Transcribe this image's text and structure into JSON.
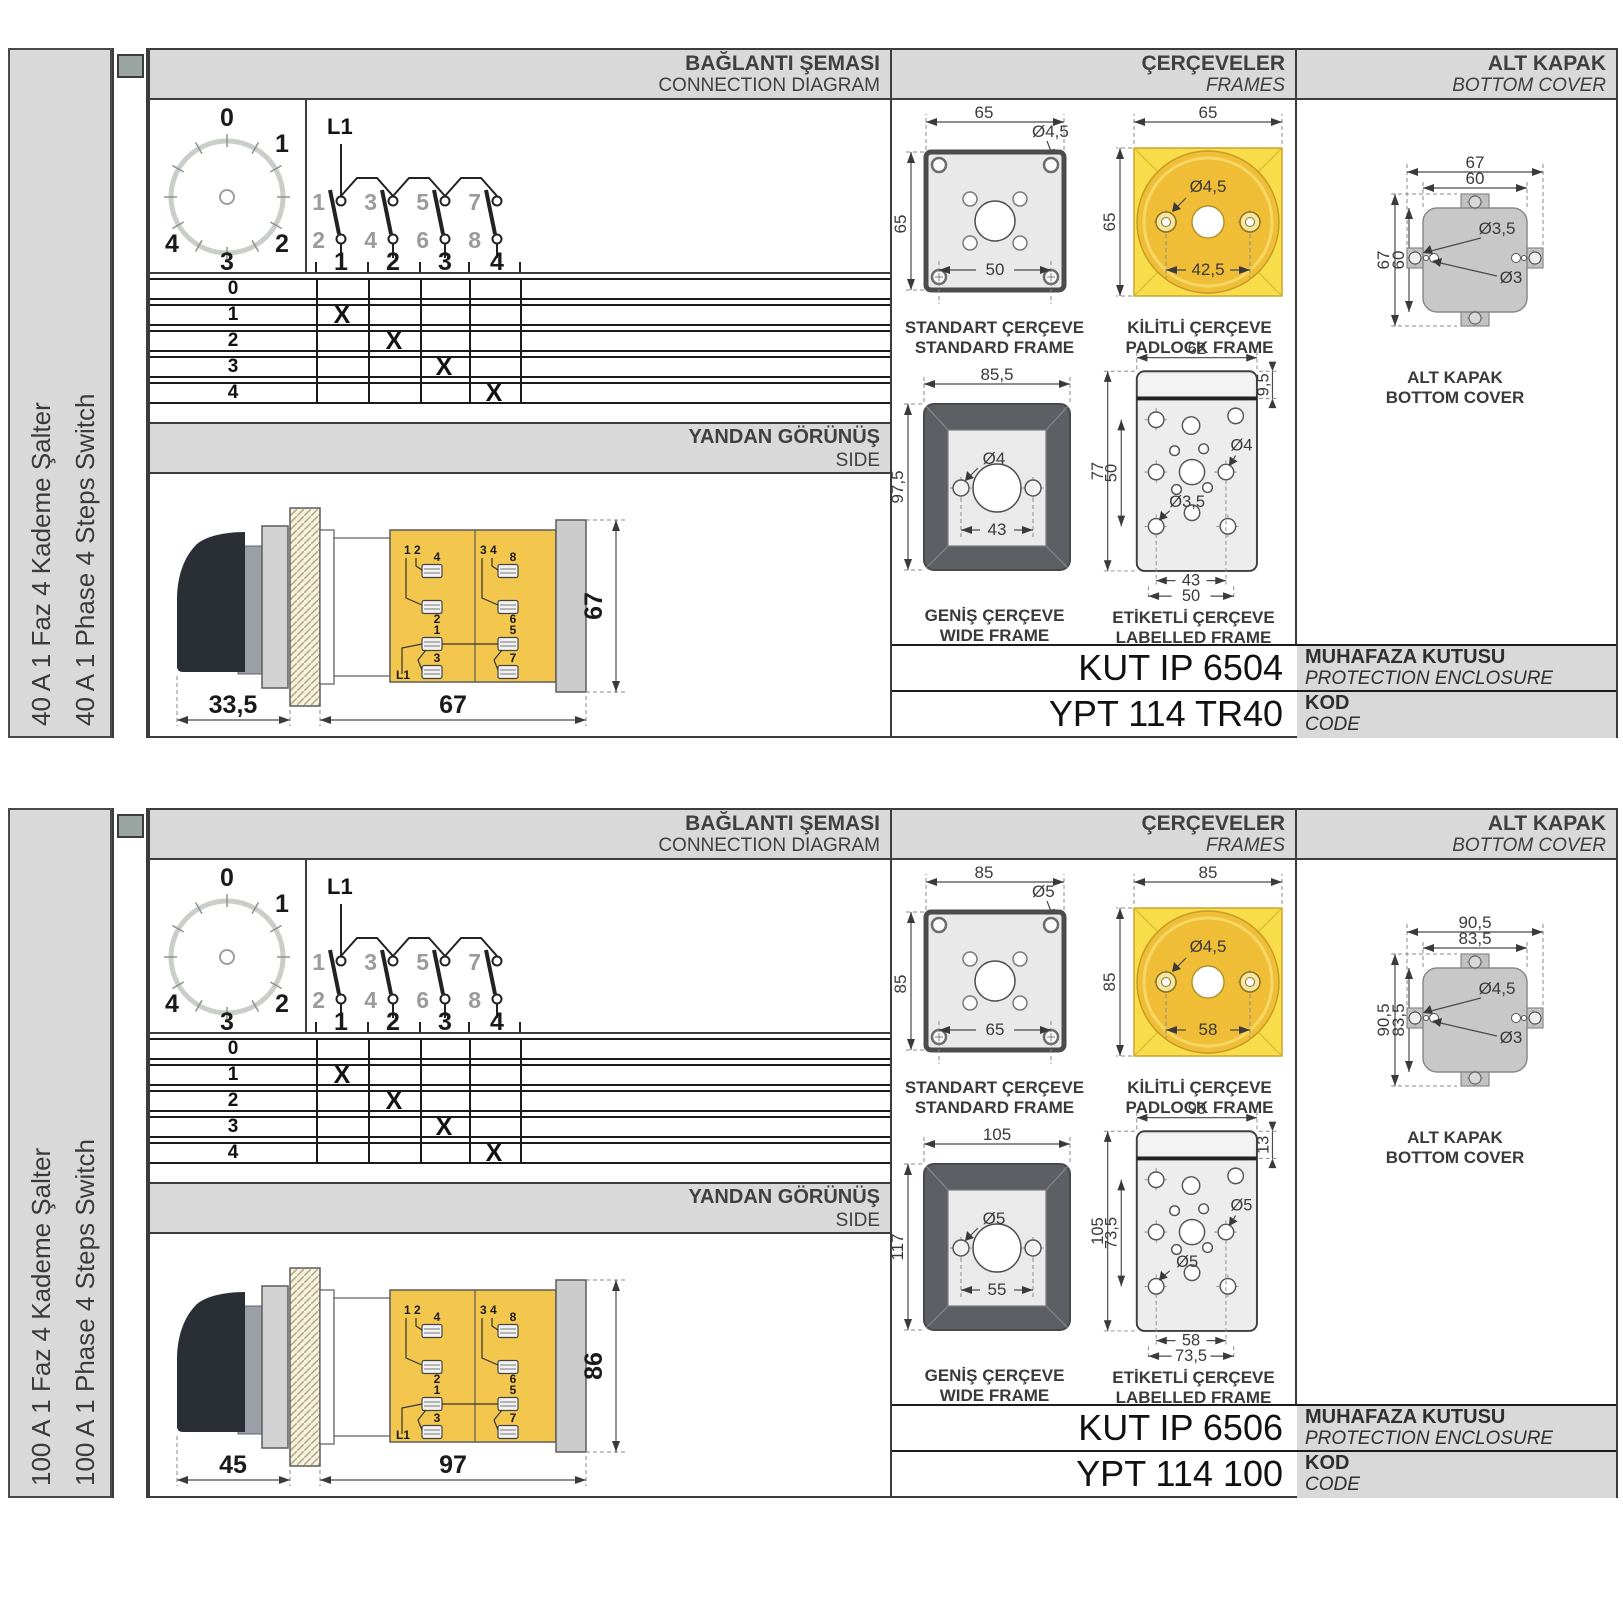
{
  "colors": {
    "panel_gray": "#d9d9d9",
    "border_dark": "#3c3c3c",
    "line_black": "#1a1a1a",
    "yellow_frame": "#f9dc49",
    "yellow_circle": "#f0bd37",
    "body_yellow": "#f3c74d",
    "frame_dark_gray": "#5c6065",
    "cover_gray": "#c8c8c8",
    "spine_square": "#9ba6a2",
    "text_dark": "#3a3a3a"
  },
  "sections": [
    {
      "side_label_tr": "40 A 1 Faz 4 Kademe Şalter",
      "side_label_en": "40 A 1 Phase 4 Steps Switch",
      "header": {
        "connection_tr": "BAĞLANTI ŞEMASI",
        "connection_en": "CONNECTION DIAGRAM",
        "frames_tr": "ÇERÇEVELER",
        "frames_en": "FRAMES",
        "cover_tr": "ALT KAPAK",
        "cover_en": "BOTTOM COVER"
      },
      "dial": {
        "labels": [
          "0",
          "1",
          "2",
          "3",
          "4"
        ]
      },
      "schematic": {
        "source": "L1",
        "top": [
          "1",
          "3",
          "5",
          "7"
        ],
        "bottom": [
          "2",
          "4",
          "6",
          "8"
        ],
        "out": [
          "1",
          "2",
          "3",
          "4"
        ]
      },
      "table": {
        "rows": [
          {
            "label": "0",
            "cells": [
              "",
              "",
              "",
              ""
            ]
          },
          {
            "label": "1",
            "cells": [
              "X",
              "",
              "",
              ""
            ]
          },
          {
            "label": "2",
            "cells": [
              "",
              "X",
              "",
              ""
            ]
          },
          {
            "label": "3",
            "cells": [
              "",
              "",
              "X",
              ""
            ]
          },
          {
            "label": "4",
            "cells": [
              "",
              "",
              "",
              "X"
            ]
          }
        ]
      },
      "side_view": {
        "title_tr": "YANDAN GÖRÜNÜŞ",
        "title_en": "SIDE",
        "dim_front": "33,5",
        "dim_body": "67",
        "dim_height": "67",
        "hdr_left": "1 2",
        "hdr_right": "3 4",
        "terminals": [
          "4",
          "2",
          "1",
          "3",
          "8",
          "6",
          "5",
          "7"
        ],
        "source": "L1"
      },
      "frames": {
        "standard": {
          "cap_tr": "STANDART ÇERÇEVE",
          "cap_en": "STANDARD FRAME",
          "dim_w": "65",
          "dim_h": "65",
          "hole": "Ø4,5",
          "dim_inner": "50"
        },
        "padlock": {
          "cap_tr": "KİLİTLİ ÇERÇEVE",
          "cap_en": "PADLOCK FRAME",
          "dim_w": "65",
          "dim_h": "65",
          "hole": "Ø4,5",
          "dim_inner": "42,5"
        },
        "wide": {
          "cap_tr": "GENİŞ ÇERÇEVE",
          "cap_en": "WIDE FRAME",
          "dim_w": "85,5",
          "dim_h": "97,5",
          "hole": "Ø4",
          "dim_inner": "43"
        },
        "labelled": {
          "cap_tr": "ETİKETLİ ÇERÇEVE",
          "cap_en": "LABELLED FRAME",
          "dim_w": "62",
          "dim_band": "9,5",
          "dim_h_outer": "77",
          "dim_h_inner": "50",
          "hole_right": "Ø4",
          "hole_left": "Ø3,5",
          "dim_inner": "43",
          "dim_outer": "50"
        }
      },
      "cover": {
        "cap_tr": "ALT KAPAK",
        "cap_en": "BOTTOM COVER",
        "dim_w_outer": "67",
        "dim_w_inner": "60",
        "dim_h_outer": "67",
        "dim_h_inner": "60",
        "hole_big": "Ø3,5",
        "hole_small": "Ø3"
      },
      "codes": {
        "enclosure_code": "KUT IP 6504",
        "enclosure_tr": "MUHAFAZA KUTUSU",
        "enclosure_en": "PROTECTION ENCLOSURE",
        "code": "YPT 114 TR40",
        "kod_tr": "KOD",
        "kod_en": "CODE"
      }
    },
    {
      "side_label_tr": "100 A 1 Faz 4 Kademe Şalter",
      "side_label_en": "100 A 1 Phase 4 Steps Switch",
      "header": {
        "connection_tr": "BAĞLANTI ŞEMASI",
        "connection_en": "CONNECTION DIAGRAM",
        "frames_tr": "ÇERÇEVELER",
        "frames_en": "FRAMES",
        "cover_tr": "ALT KAPAK",
        "cover_en": "BOTTOM COVER"
      },
      "dial": {
        "labels": [
          "0",
          "1",
          "2",
          "3",
          "4"
        ]
      },
      "schematic": {
        "source": "L1",
        "top": [
          "1",
          "3",
          "5",
          "7"
        ],
        "bottom": [
          "2",
          "4",
          "6",
          "8"
        ],
        "out": [
          "1",
          "2",
          "3",
          "4"
        ]
      },
      "table": {
        "rows": [
          {
            "label": "0",
            "cells": [
              "",
              "",
              "",
              ""
            ]
          },
          {
            "label": "1",
            "cells": [
              "X",
              "",
              "",
              ""
            ]
          },
          {
            "label": "2",
            "cells": [
              "",
              "X",
              "",
              ""
            ]
          },
          {
            "label": "3",
            "cells": [
              "",
              "",
              "X",
              ""
            ]
          },
          {
            "label": "4",
            "cells": [
              "",
              "",
              "",
              "X"
            ]
          }
        ]
      },
      "side_view": {
        "title_tr": "YANDAN GÖRÜNÜŞ",
        "title_en": "SIDE",
        "dim_front": "45",
        "dim_body": "97",
        "dim_height": "86",
        "hdr_left": "1 2",
        "hdr_right": "3 4",
        "terminals": [
          "4",
          "2",
          "1",
          "3",
          "8",
          "6",
          "5",
          "7"
        ],
        "source": "L1"
      },
      "frames": {
        "standard": {
          "cap_tr": "STANDART ÇERÇEVE",
          "cap_en": "STANDARD FRAME",
          "dim_w": "85",
          "dim_h": "85",
          "hole": "Ø5",
          "dim_inner": "65"
        },
        "padlock": {
          "cap_tr": "KİLİTLİ ÇERÇEVE",
          "cap_en": "PADLOCK FRAME",
          "dim_w": "85",
          "dim_h": "85",
          "hole": "Ø4,5",
          "dim_inner": "58"
        },
        "wide": {
          "cap_tr": "GENİŞ ÇERÇEVE",
          "cap_en": "WIDE FRAME",
          "dim_w": "105",
          "dim_h": "117",
          "hole": "Ø5",
          "dim_inner": "55"
        },
        "labelled": {
          "cap_tr": "ETİKETLİ ÇERÇEVE",
          "cap_en": "LABELLED FRAME",
          "dim_w": "90",
          "dim_band": "13",
          "dim_h_outer": "105",
          "dim_h_inner": "73,5",
          "hole_right": "Ø5",
          "hole_left": "Ø5",
          "dim_inner": "58",
          "dim_outer": "73,5"
        }
      },
      "cover": {
        "cap_tr": "ALT KAPAK",
        "cap_en": "BOTTOM COVER",
        "dim_w_outer": "90,5",
        "dim_w_inner": "83,5",
        "dim_h_outer": "90,5",
        "dim_h_inner": "83,5",
        "hole_big": "Ø4,5",
        "hole_small": "Ø3"
      },
      "codes": {
        "enclosure_code": "KUT IP 6506",
        "enclosure_tr": "MUHAFAZA KUTUSU",
        "enclosure_en": "PROTECTION ENCLOSURE",
        "code": "YPT 114 100",
        "kod_tr": "KOD",
        "kod_en": "CODE"
      }
    }
  ]
}
